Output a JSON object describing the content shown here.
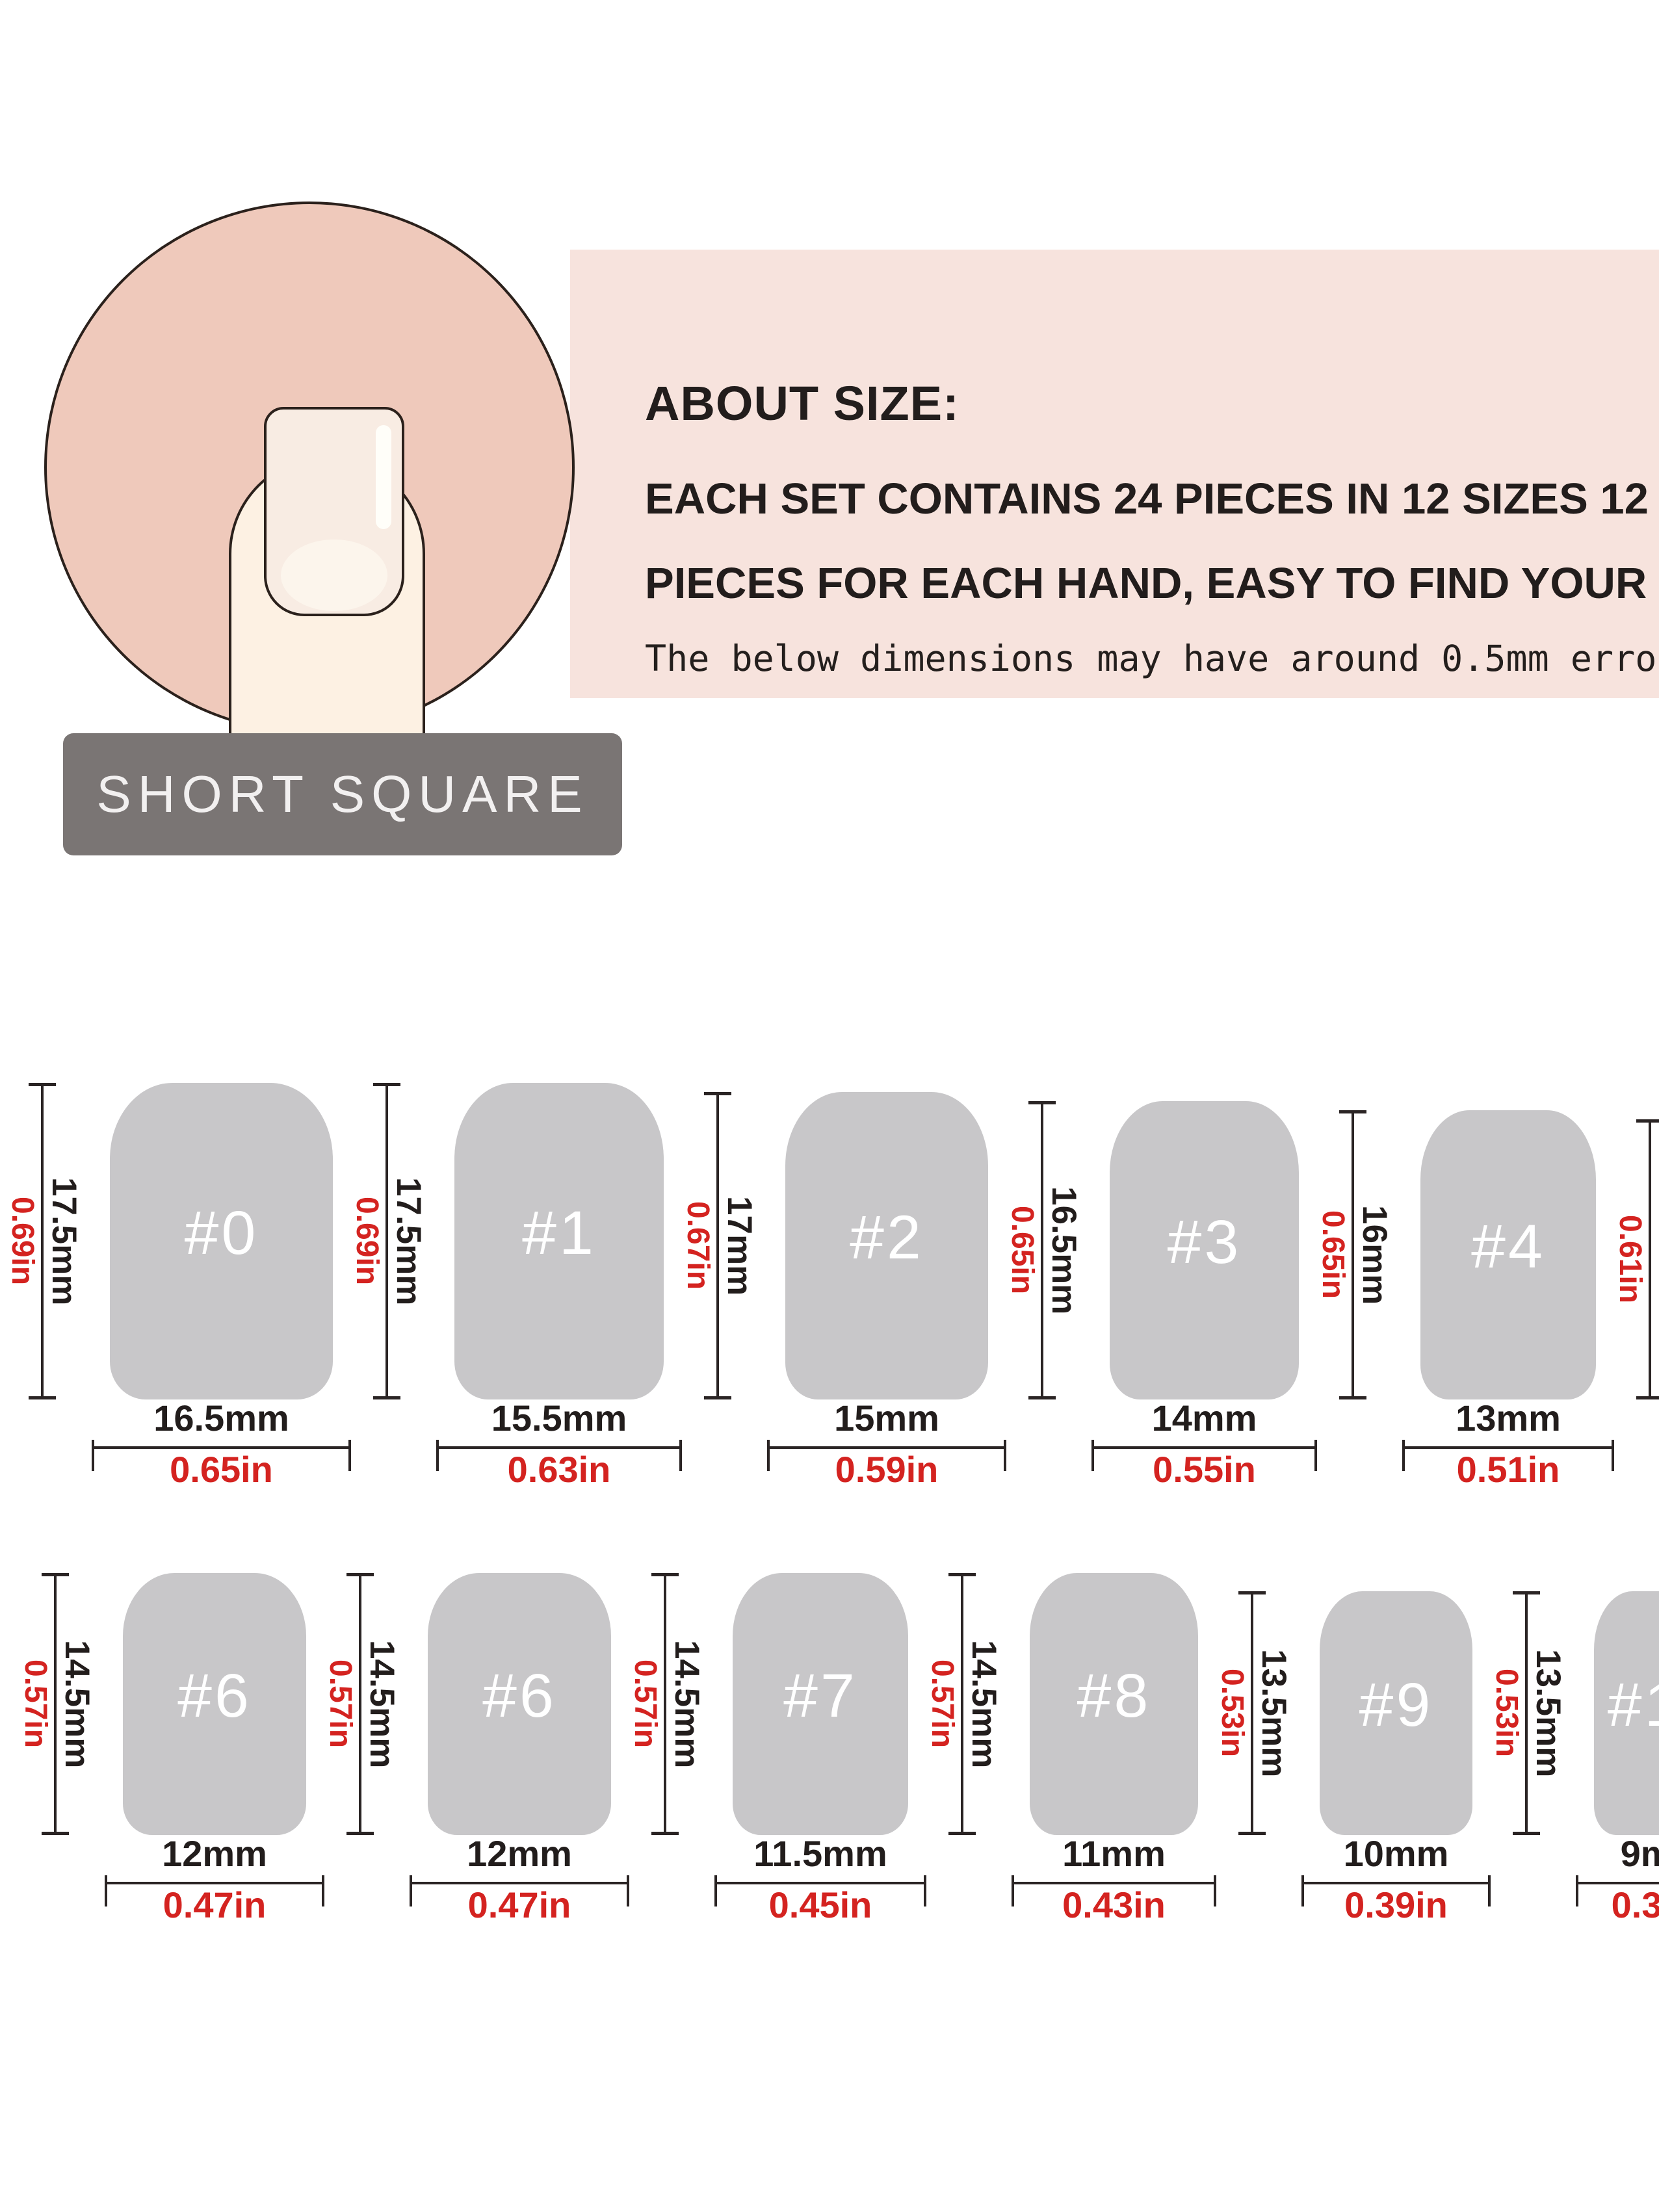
{
  "shape_label": "SHORT SQUARE",
  "about": {
    "title": "ABOUT SIZE:",
    "line1": "EACH SET CONTAINS 24 PIECES IN 12 SIZES 12",
    "line2": "PIECES FOR EACH HAND, EASY TO FIND YOUR SIZE",
    "note": "The below dimensions may have around 0.5mm error"
  },
  "colors": {
    "banner_pink": "#f7e3dd",
    "circle_pink": "#efc9bb",
    "skin": "#fdf1e3",
    "nail_plate": "#f8ece3",
    "badge_gray": "#7a7574",
    "nail_gray": "#c8c7c9",
    "accent_red": "#d42320",
    "ink": "#221d1c"
  },
  "rows": [
    {
      "nails": [
        {
          "num": "#0",
          "h": 17.5,
          "w": 16.5,
          "h_mm": "17.5mm",
          "h_in": "0.69in",
          "w_mm": "16.5mm",
          "w_in": "0.65in"
        },
        {
          "num": "#1",
          "h": 17.5,
          "w": 15.5,
          "h_mm": "17.5mm",
          "h_in": "0.69in",
          "w_mm": "15.5mm",
          "w_in": "0.63in"
        },
        {
          "num": "#2",
          "h": 17,
          "w": 15,
          "h_mm": "17mm",
          "h_in": "0.67in",
          "w_mm": "15mm",
          "w_in": "0.59in"
        },
        {
          "num": "#3",
          "h": 16.5,
          "w": 14,
          "h_mm": "16.5mm",
          "h_in": "0.65in",
          "w_mm": "14mm",
          "w_in": "0.55in"
        },
        {
          "num": "#4",
          "h": 16,
          "w": 13,
          "h_mm": "16mm",
          "h_in": "0.65in",
          "w_mm": "13mm",
          "w_in": "0.51in"
        },
        {
          "num": "#5",
          "h": 15.5,
          "w": 12.5,
          "h_mm": "15.5mm",
          "h_in": "0.61in",
          "w_mm": "12.5mm",
          "w_in": "0.49in"
        }
      ]
    },
    {
      "nails": [
        {
          "num": "#6",
          "h": 14.5,
          "w": 12,
          "h_mm": "14.5mm",
          "h_in": "0.57in",
          "w_mm": "12mm",
          "w_in": "0.47in"
        },
        {
          "num": "#6",
          "h": 14.5,
          "w": 12,
          "h_mm": "14.5mm",
          "h_in": "0.57in",
          "w_mm": "12mm",
          "w_in": "0.47in"
        },
        {
          "num": "#7",
          "h": 14.5,
          "w": 11.5,
          "h_mm": "14.5mm",
          "h_in": "0.57in",
          "w_mm": "11.5mm",
          "w_in": "0.45in"
        },
        {
          "num": "#8",
          "h": 14.5,
          "w": 11,
          "h_mm": "14.5mm",
          "h_in": "0.57in",
          "w_mm": "11mm",
          "w_in": "0.43in"
        },
        {
          "num": "#9",
          "h": 13.5,
          "w": 10,
          "h_mm": "13.5mm",
          "h_in": "0.53in",
          "w_mm": "10mm",
          "w_in": "0.39in"
        },
        {
          "num": "#10",
          "h": 13.5,
          "w": 9,
          "h_mm": "13.5mm",
          "h_in": "0.53in",
          "w_mm": "9mm",
          "w_in": "0.35in"
        }
      ]
    }
  ]
}
